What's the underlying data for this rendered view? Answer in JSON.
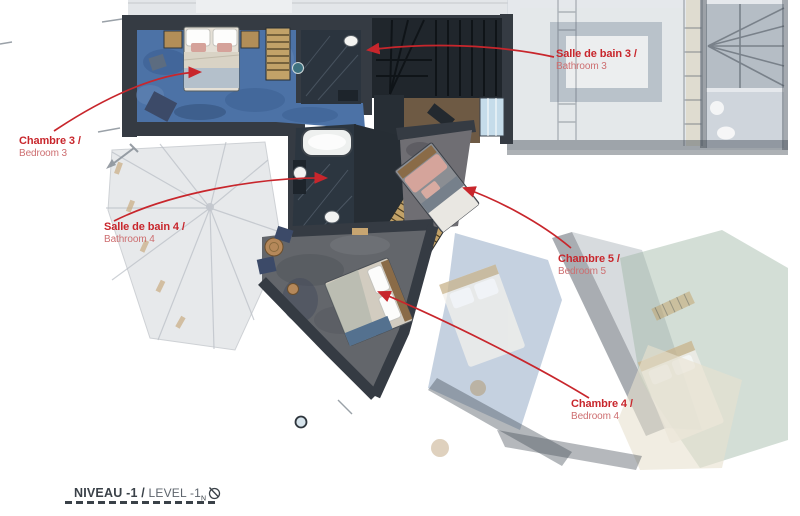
{
  "annotations": {
    "chambre3": {
      "title": "Chambre 3 /",
      "subtitle": "Bedroom 3"
    },
    "sdb3": {
      "title": "Salle de bain 3 /",
      "subtitle": "Bathroom 3"
    },
    "sdb4": {
      "title": "Salle de bain 4 /",
      "subtitle": "Bathroom 4"
    },
    "chambre5": {
      "title": "Chambre 5 /",
      "subtitle": "Bedroom 5"
    },
    "chambre4": {
      "title": "Chambre 4 /",
      "subtitle": "Bedroom 4"
    }
  },
  "footer": {
    "level_fr": "NIVEAU -1 /",
    "level_en": " LEVEL -1",
    "north_letter": "N"
  },
  "icons": {
    "compass": "north-compass-icon"
  },
  "colors": {
    "accent_red": "#c8262c",
    "accent_red_light": "#cd6e70",
    "ink": "#3a4148",
    "ink_light": "#5d646c",
    "wall_dark": "#353b43",
    "stairs_dark": "#20262c",
    "carpet_blue": "#4c72a6",
    "carpet_gray": "#67696e",
    "marble_dark": "#2b343e",
    "wood": "#c2a268",
    "faded_green": "#9db5a3",
    "faded_blue": "#7e98ba"
  }
}
